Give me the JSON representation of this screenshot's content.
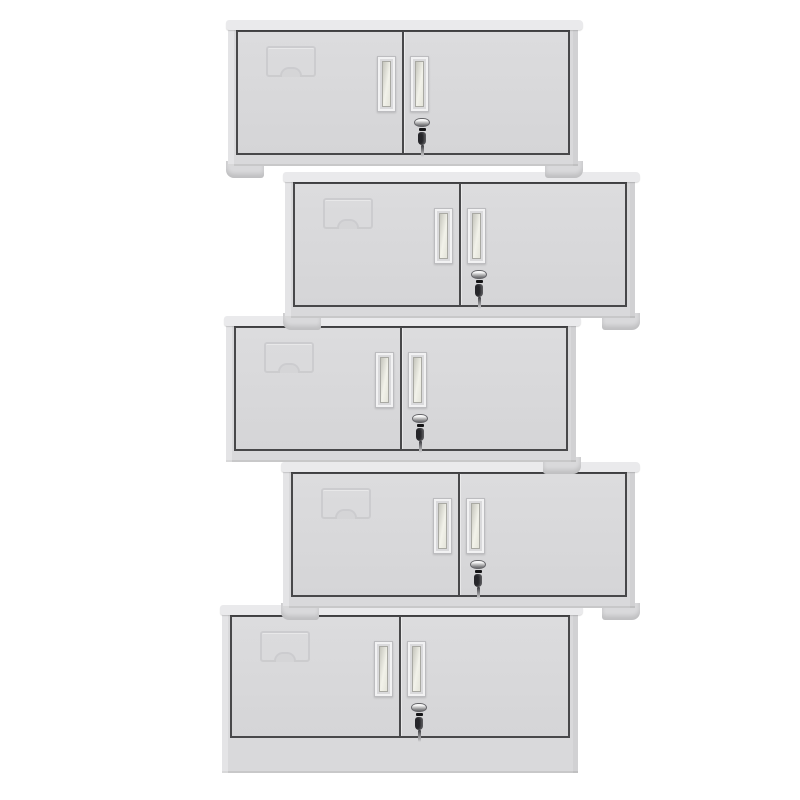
{
  "scene": {
    "description": "Product photo: five light-gray two-door steel office cabinets stacked in an alternating zigzag tower on a plain white background",
    "background_color": "#ffffff",
    "width": 800,
    "height": 800
  },
  "colors": {
    "body": "#d9d9db",
    "lid": "#eaeaec",
    "door_face": "#d5d5d7",
    "door_face_light": "#dcdcde",
    "frame_line": "#48484a",
    "label_outline": "#c9c9cc",
    "handle_outer": "#dadadc",
    "handle_border": "#bcbcbf",
    "handle_slot_light": "#f2f2ea",
    "handle_slot_dark": "#c6c6bd",
    "lock_chrome_light": "#f8f8f8",
    "lock_chrome_dark": "#8e8e90",
    "key_color": "#26262a"
  },
  "cabinet_features": {
    "doors_per_cabinet": 2,
    "handle_type": "recessed-vertical-pulls",
    "lock": "chrome-cam-lock-with-hanging-key-on-right-door",
    "label_holder": "embossed-card-holder-on-left-door"
  },
  "cabinets": [
    {
      "name": "cabinet-1",
      "x": 228,
      "y": 20,
      "width": 350,
      "height": 146,
      "base": "feet",
      "feet": [
        "left",
        "right"
      ]
    },
    {
      "name": "cabinet-2",
      "x": 285,
      "y": 172,
      "width": 350,
      "height": 146,
      "base": "feet",
      "feet": [
        "left",
        "right"
      ]
    },
    {
      "name": "cabinet-3",
      "x": 226,
      "y": 316,
      "width": 350,
      "height": 146,
      "base": "feet",
      "feet": [
        "right"
      ]
    },
    {
      "name": "cabinet-4",
      "x": 283,
      "y": 462,
      "width": 352,
      "height": 146,
      "base": "feet",
      "feet": [
        "left",
        "right"
      ]
    },
    {
      "name": "cabinet-5",
      "x": 222,
      "y": 605,
      "width": 356,
      "height": 168,
      "base": "plinth",
      "feet": []
    }
  ]
}
